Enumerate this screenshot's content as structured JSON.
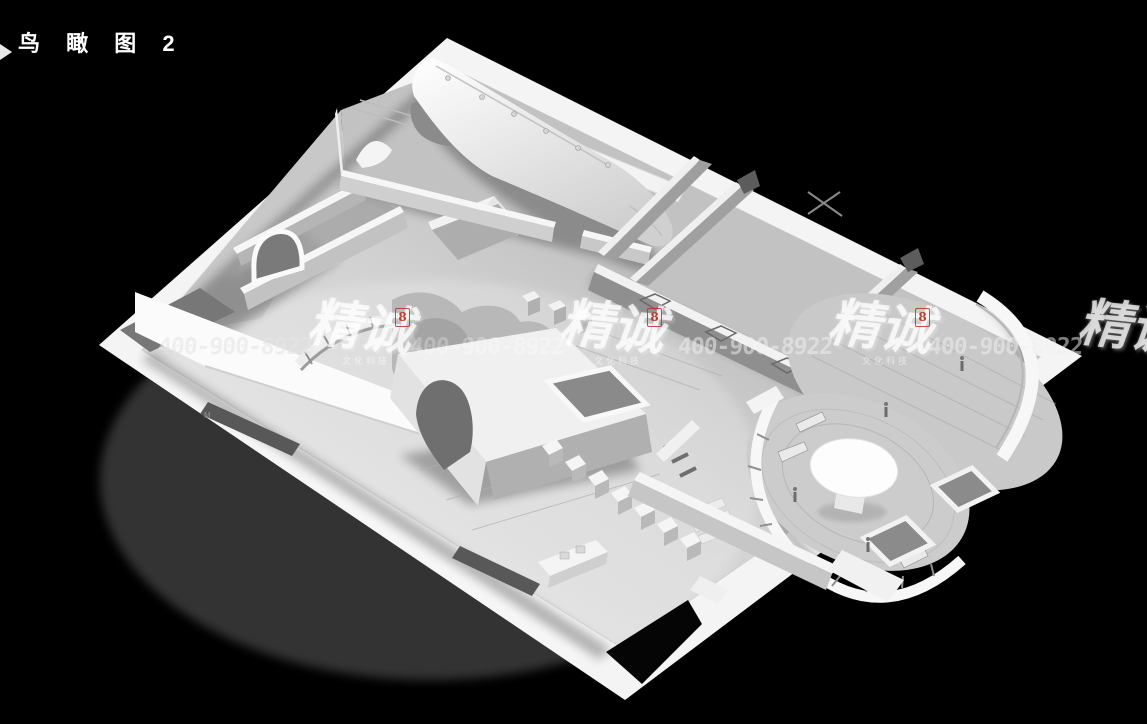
{
  "page": {
    "background_color": "#000000",
    "width": 1147,
    "height": 724
  },
  "header": {
    "title": "鸟 瞰 图 2",
    "title_color": "#ffffff"
  },
  "scene": {
    "floor_mark": "M",
    "palette": {
      "background": "#000000",
      "floor_light": "#e9e9e9",
      "floor_dark": "#999999",
      "walls": "#f5f5f5",
      "wall_shadow": "#8f8f8f"
    }
  },
  "watermark": {
    "phone": "400-900-8922",
    "brand": "精诚",
    "brand_sub": "文化科技",
    "seal_glyph": "8",
    "text_color": "rgba(255,255,255,0.5)",
    "seal_color": "#bf3a2b"
  }
}
